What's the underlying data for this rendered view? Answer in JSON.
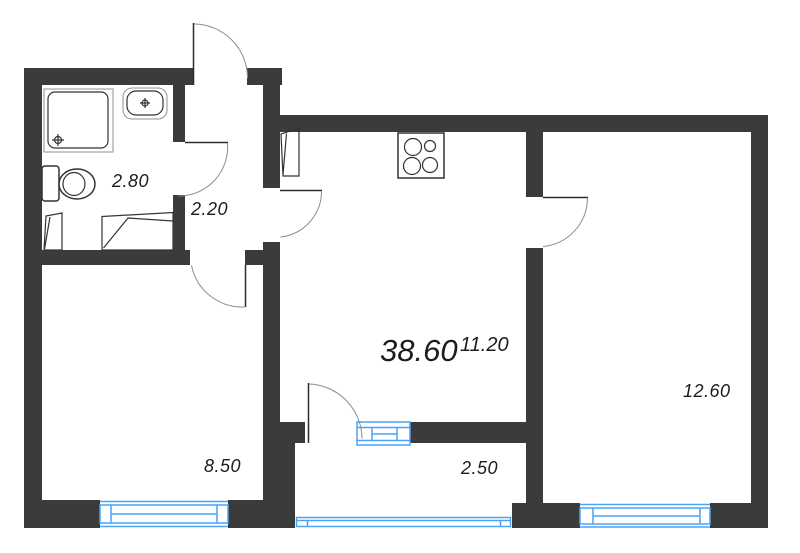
{
  "floor_plan": {
    "total_area_label": "38.60",
    "rooms": [
      {
        "name": "bathroom",
        "area_label": "2.80"
      },
      {
        "name": "hallway",
        "area_label": "2.20"
      },
      {
        "name": "kitchen-living-room",
        "area_label": "11.20"
      },
      {
        "name": "room-right",
        "area_label": "12.60"
      },
      {
        "name": "room-left",
        "area_label": "8.50"
      },
      {
        "name": "balcony",
        "area_label": "2.50"
      }
    ],
    "fixtures": [
      "shower-icon",
      "sink-icon",
      "toilet-icon",
      "stove-icon",
      "wardrobe-icon"
    ],
    "colors": {
      "wall": "#3b3b3b",
      "window": "#4aa3f7",
      "outline": "#333333",
      "arc": "#8e8e8e",
      "text": "#1c1c1c",
      "background": "#ffffff"
    }
  }
}
